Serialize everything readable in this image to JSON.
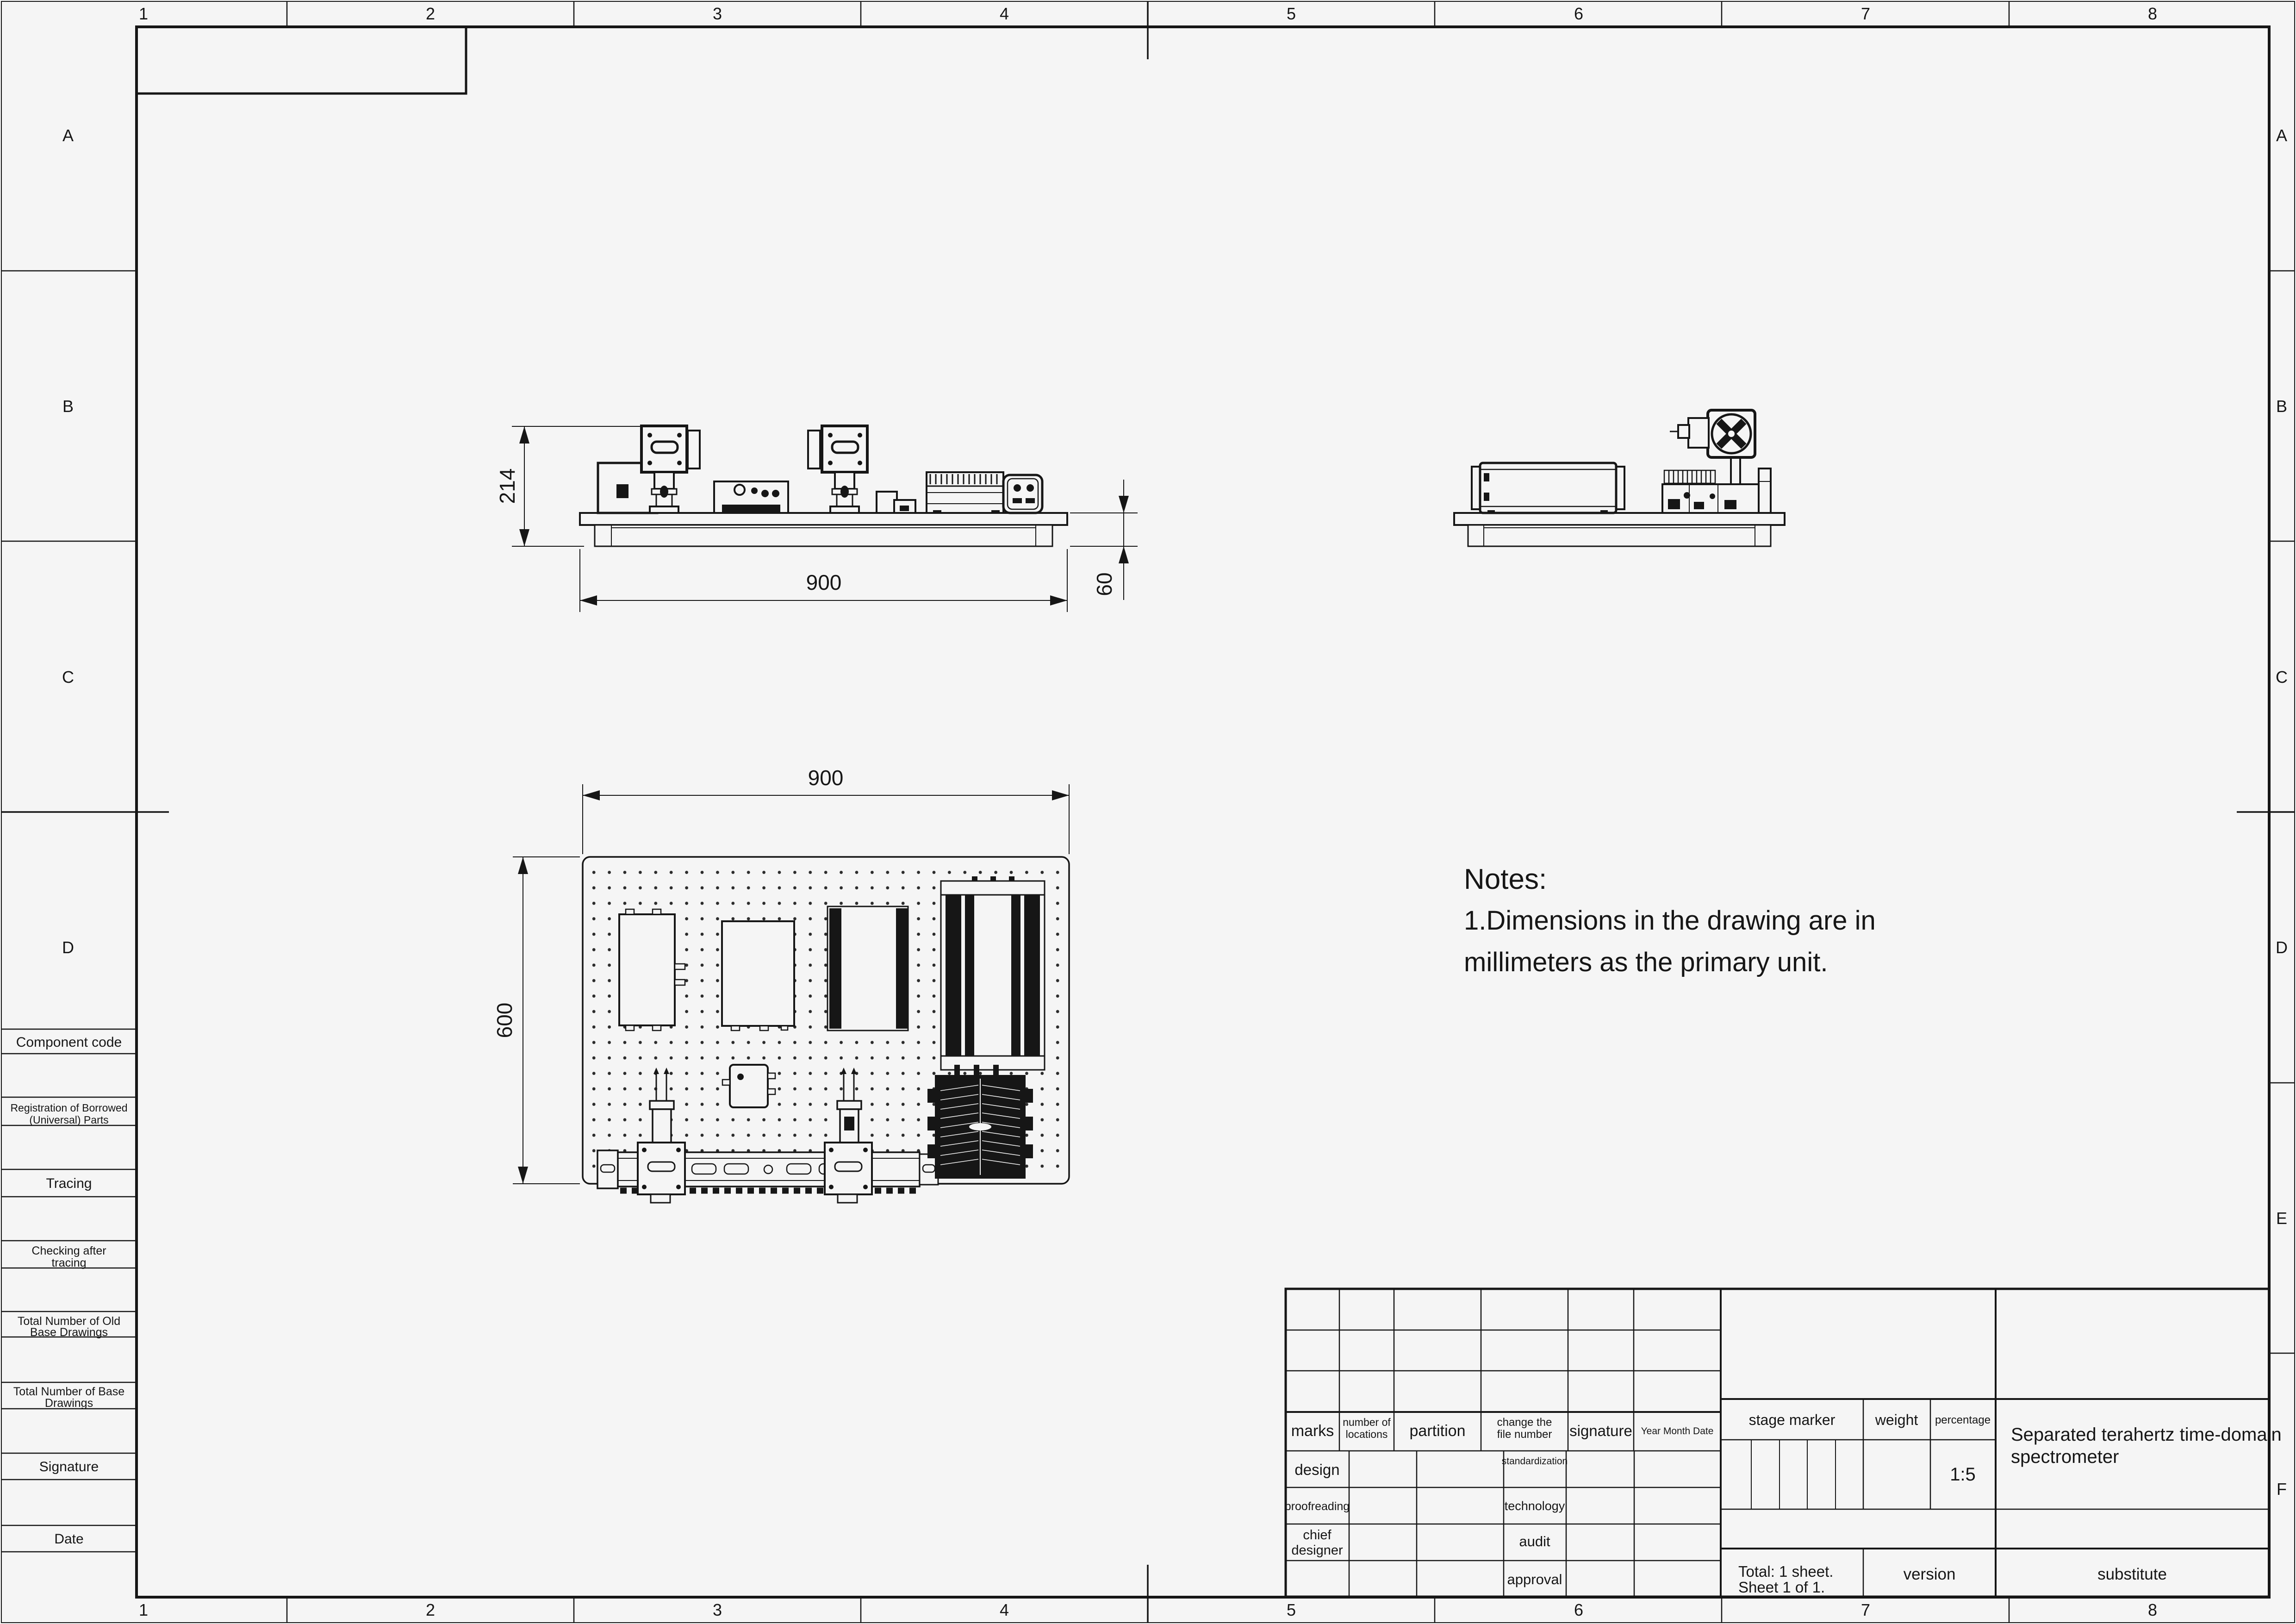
{
  "sheet": {
    "zones": {
      "columns": [
        "1",
        "2",
        "3",
        "4",
        "5",
        "6",
        "7",
        "8"
      ],
      "rows": [
        "A",
        "B",
        "C",
        "D",
        "E",
        "F"
      ]
    }
  },
  "notes": {
    "heading": "Notes:",
    "line1": "1.Dimensions in the drawing are in",
    "line2": "millimeters as the primary unit."
  },
  "dims": {
    "front_total_height": "214",
    "front_board_width": "900",
    "front_base_height": "60",
    "plan_width": "900",
    "plan_depth": "600"
  },
  "left_table": {
    "component_code": "Component code",
    "registration_line1": "Registration of Borrowed",
    "registration_line2": "(Universal) Parts",
    "tracing": "Tracing",
    "checking_line1": "Checking after",
    "checking_line2": "tracing",
    "old_base_line1": "Total Number of Old",
    "old_base_line2": "Base Drawings",
    "base_line1": "Total Number of Base",
    "base_line2": "Drawings",
    "signature": "Signature",
    "date": "Date"
  },
  "title_block": {
    "marks": "marks",
    "locations_line1": "number of",
    "locations_line2": "locations",
    "partition": "partition",
    "change_line1": "change the",
    "change_line2": "file number",
    "signature": "signature",
    "ymd": "Year  Month  Date",
    "design": "design",
    "proofreading": "proofreading",
    "chief_line1": "chief",
    "chief_line2": "designer",
    "standardization": "standardization",
    "technology": "technology",
    "audit": "audit",
    "approval": "approval",
    "stage_marker": "stage marker",
    "weight": "weight",
    "percentage": "percentage",
    "scale": "1:5",
    "title_line1": "Separated terahertz time-domain",
    "title_line2": "spectrometer",
    "total_line1": "Total: 1 sheet.",
    "total_line2": "Sheet 1 of 1.",
    "version": "version",
    "substitute": "substitute"
  }
}
